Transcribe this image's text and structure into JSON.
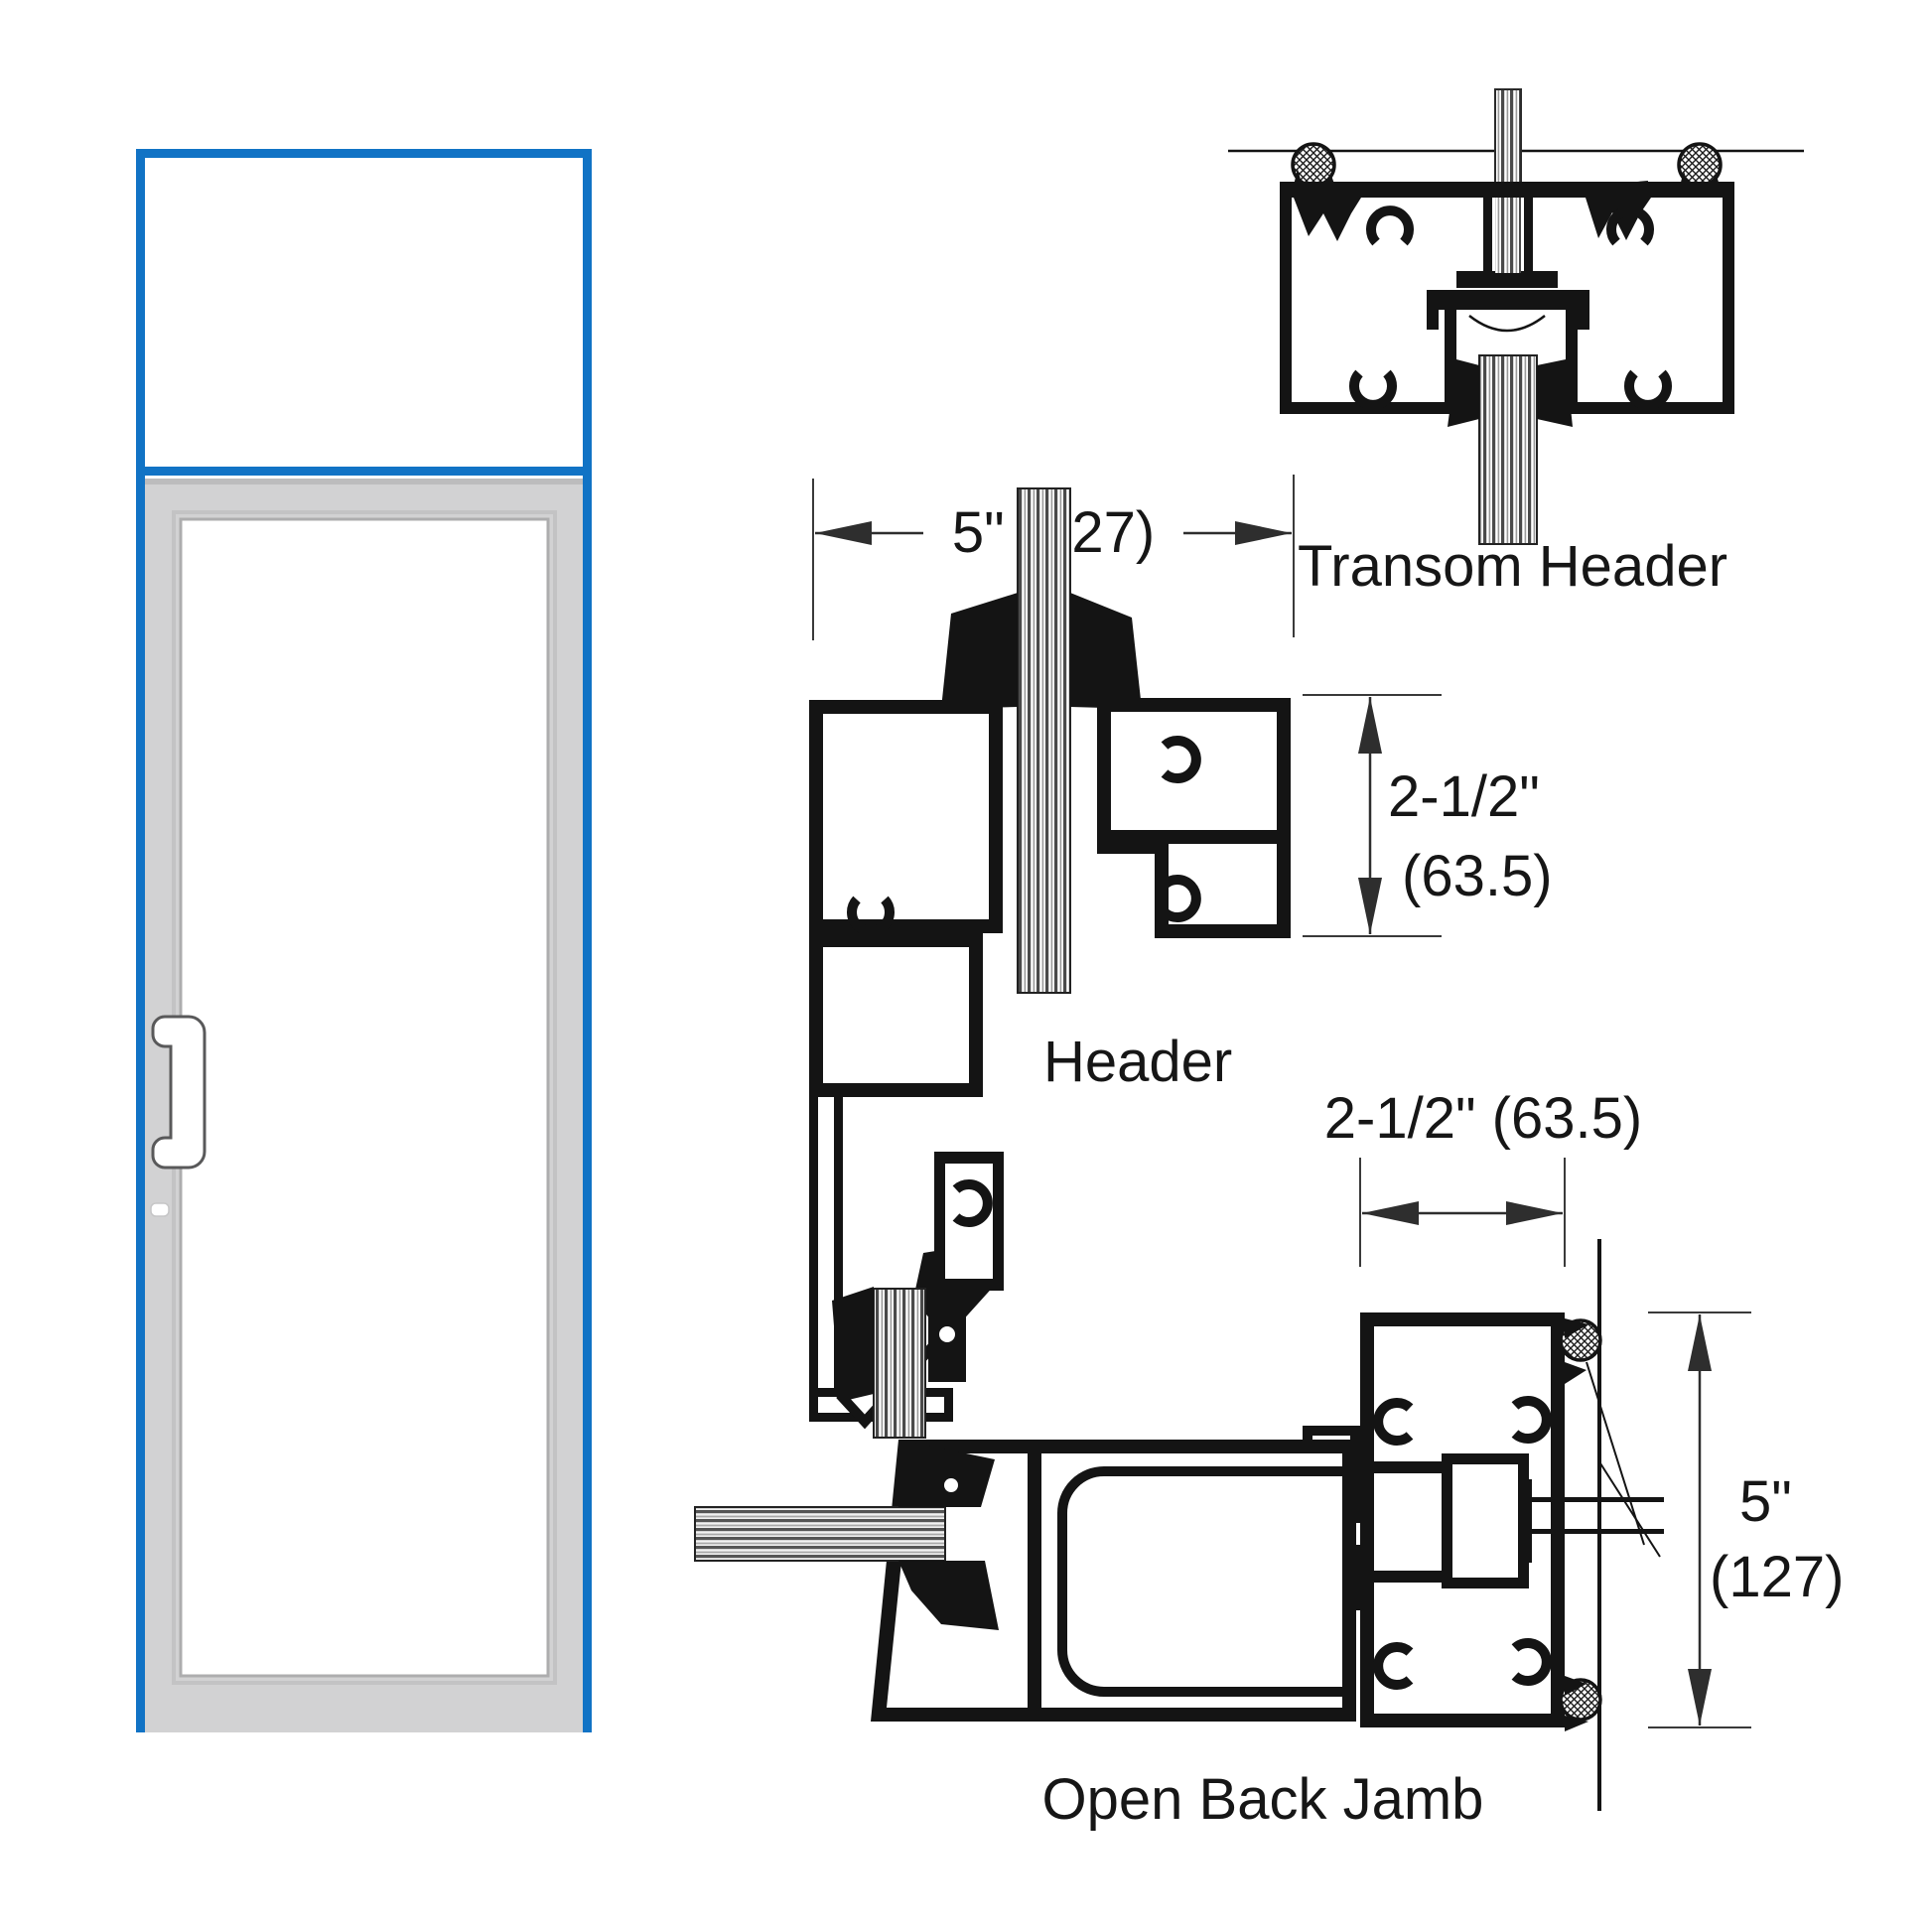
{
  "figure": {
    "title_hint": "storefront door with transom - frame section details",
    "elevation": {
      "parts": [
        "transom-panel",
        "door-panel",
        "door-glass",
        "door-handle",
        "lock-indicator"
      ],
      "accent_blue": "#1173c5",
      "frame_gray": "#d2d2d3"
    },
    "sections": {
      "transom_header": {
        "label": "Transom Header"
      },
      "header": {
        "label": "Header"
      },
      "open_back_jamb": {
        "label": "Open Back Jamb"
      }
    },
    "dimensions": {
      "header_width": "5\" (127)",
      "header_face_depth_line1": "2-1/2\"",
      "header_face_depth_line2": "(63.5)",
      "jamb_face_width": "2-1/2\" (63.5)",
      "jamb_depth_line1": "5\"",
      "jamb_depth_line2": "(127)"
    },
    "colors": {
      "accent_blue": "#1173c5",
      "frame_gray": "#d2d2d3",
      "line_black": "#141414"
    }
  }
}
